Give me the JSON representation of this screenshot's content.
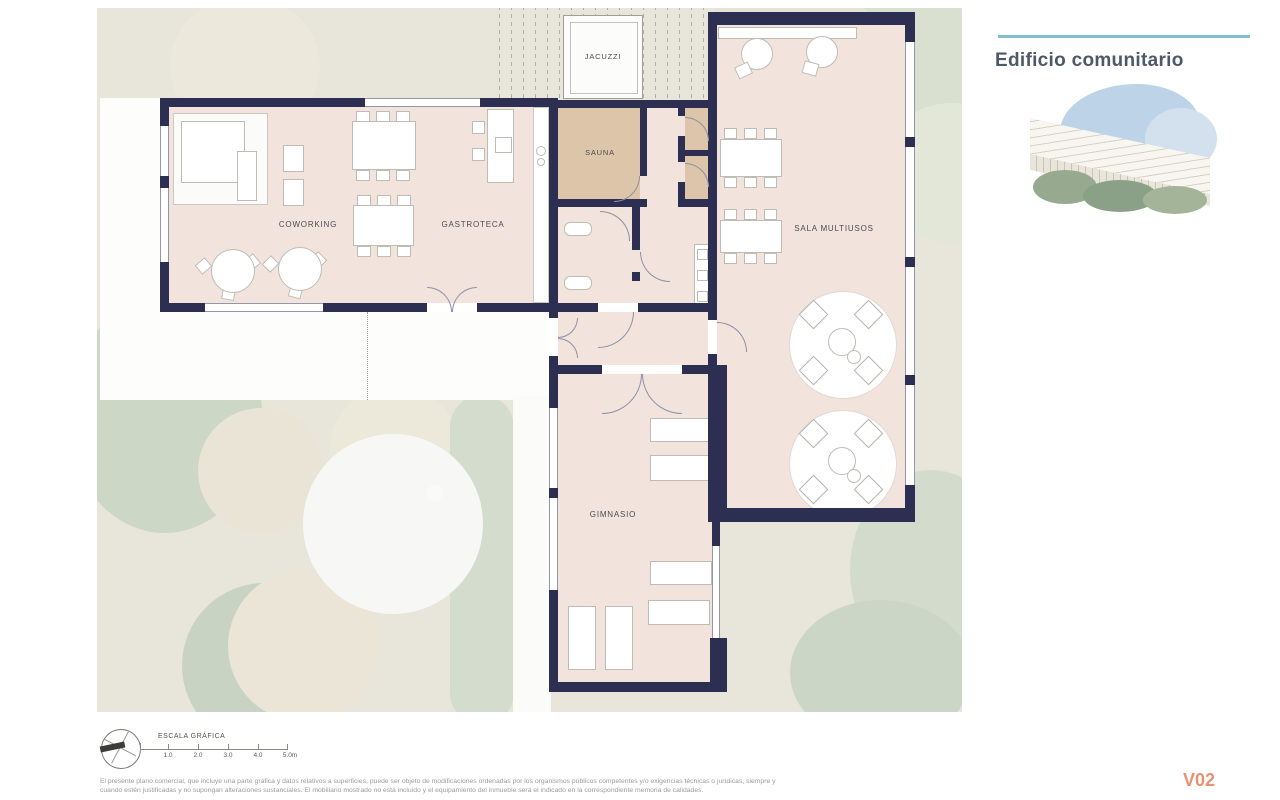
{
  "plan": {
    "rooms": [
      {
        "id": "jacuzzi",
        "label": "JACUZZI"
      },
      {
        "id": "sauna",
        "label": "SAUNA"
      },
      {
        "id": "coworking",
        "label": "COWORKING"
      },
      {
        "id": "gastroteca",
        "label": "GASTROTECA"
      },
      {
        "id": "sala-multiusos",
        "label": "SALA MULTIUSOS"
      },
      {
        "id": "gimnasio",
        "label": "GIMNASIO"
      }
    ],
    "scale_bar": {
      "title": "ESCALA GRÁFICA",
      "tick_labels": [
        "1.0",
        "2.0",
        "3.0",
        "4.0",
        "5.0m"
      ]
    },
    "colors": {
      "wall": "#2d2f52",
      "floor": "#f2e4dc",
      "sauna_floor": "#dcc5a8",
      "site": "#e8e5da",
      "greenery": "#cdd7c7"
    }
  },
  "side_panel": {
    "title": "Edificio comunitario",
    "accent_line_color": "#7fc0cc"
  },
  "footer": {
    "disclaimer_line1": "El presente plano comercial, que incluye una parte gráfica y datos relativos a superficies, puede ser objeto de modificaciones ordenadas por los organismos públicos competentes y/o exigencias técnicas o jurídicas, siempre y",
    "disclaimer_line2": "cuando estén justificadas y no supongan alteraciones sustanciales. El mobiliario mostrado no está incluido y el equipamiento del inmueble será el indicado en la correspondiente memoria de calidades.",
    "version": "V02",
    "version_color": "#e9906f"
  }
}
